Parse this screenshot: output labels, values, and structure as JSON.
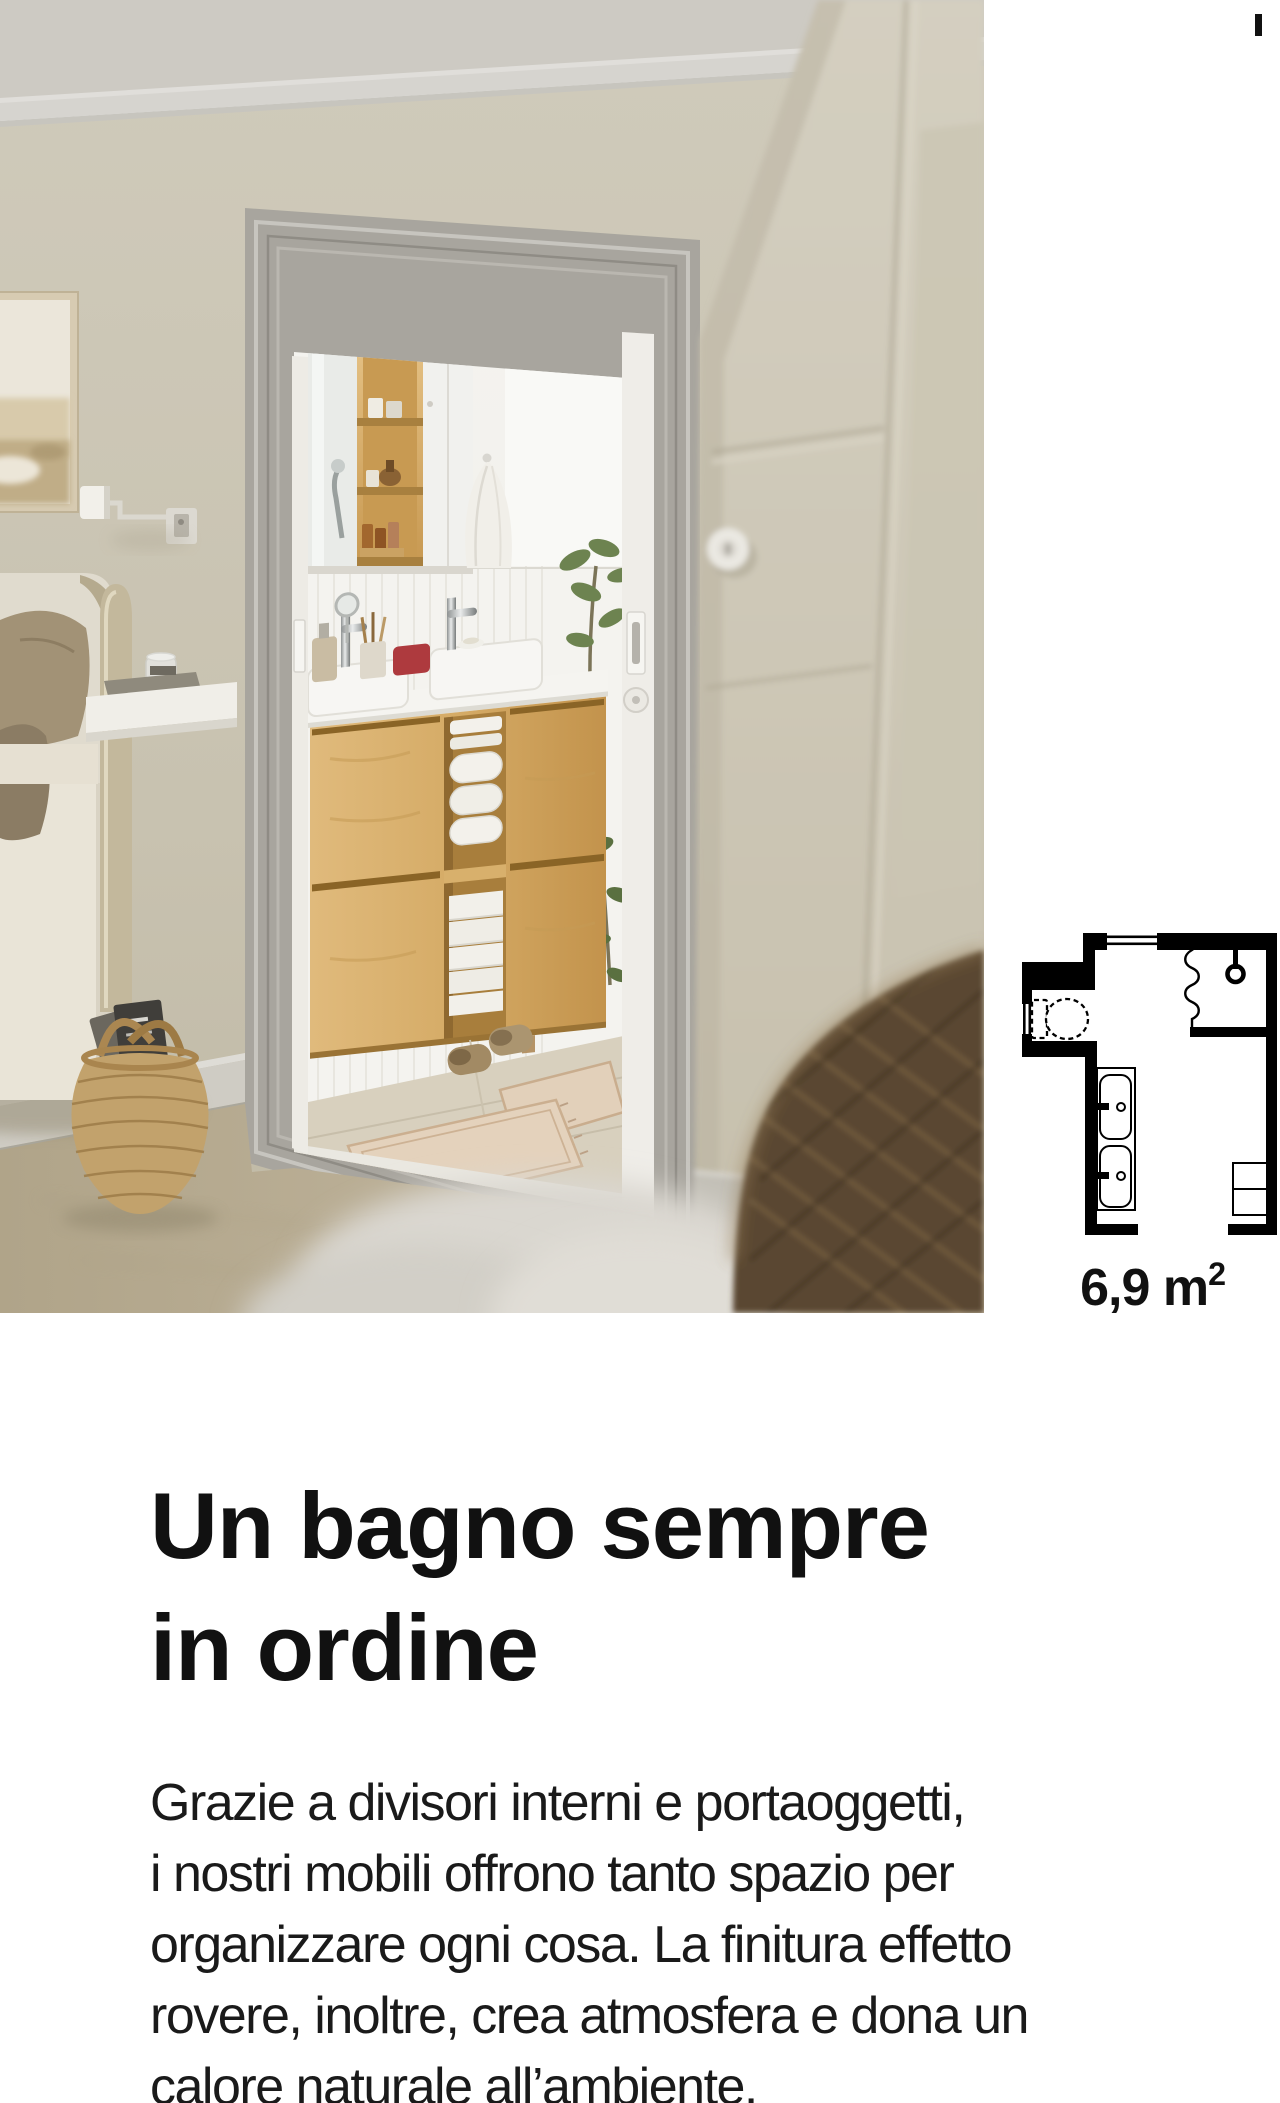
{
  "heading": {
    "lines": [
      "Un bagno sempre",
      "in ordine"
    ]
  },
  "body": {
    "lines": [
      "Grazie a divisori interni e portaoggetti,",
      "i nostri mobili offrono tanto spazio per",
      "organizzare ogni cosa. La finitura effetto",
      "rovere, inoltre, crea atmosfera e dona un",
      "calore naturale all’ambiente."
    ]
  },
  "floorplan": {
    "area_label": "6,9 m",
    "area_sup": "2"
  },
  "colors": {
    "page-bg": "#ffffff",
    "ink": "#111111",
    "body-ink": "#1a1a1a",
    "plan": "#000000",
    "wall": "#c8c2b0",
    "door-frame": "#a8a59e",
    "oak": "#d5ab66",
    "bathroom-white": "#f2f1ed",
    "carpet": "#bcb097",
    "accent-red": "#ae3a3e",
    "plant-green": "#6d8350",
    "basket": "#c2a26c",
    "wicker": "#5a4731"
  }
}
